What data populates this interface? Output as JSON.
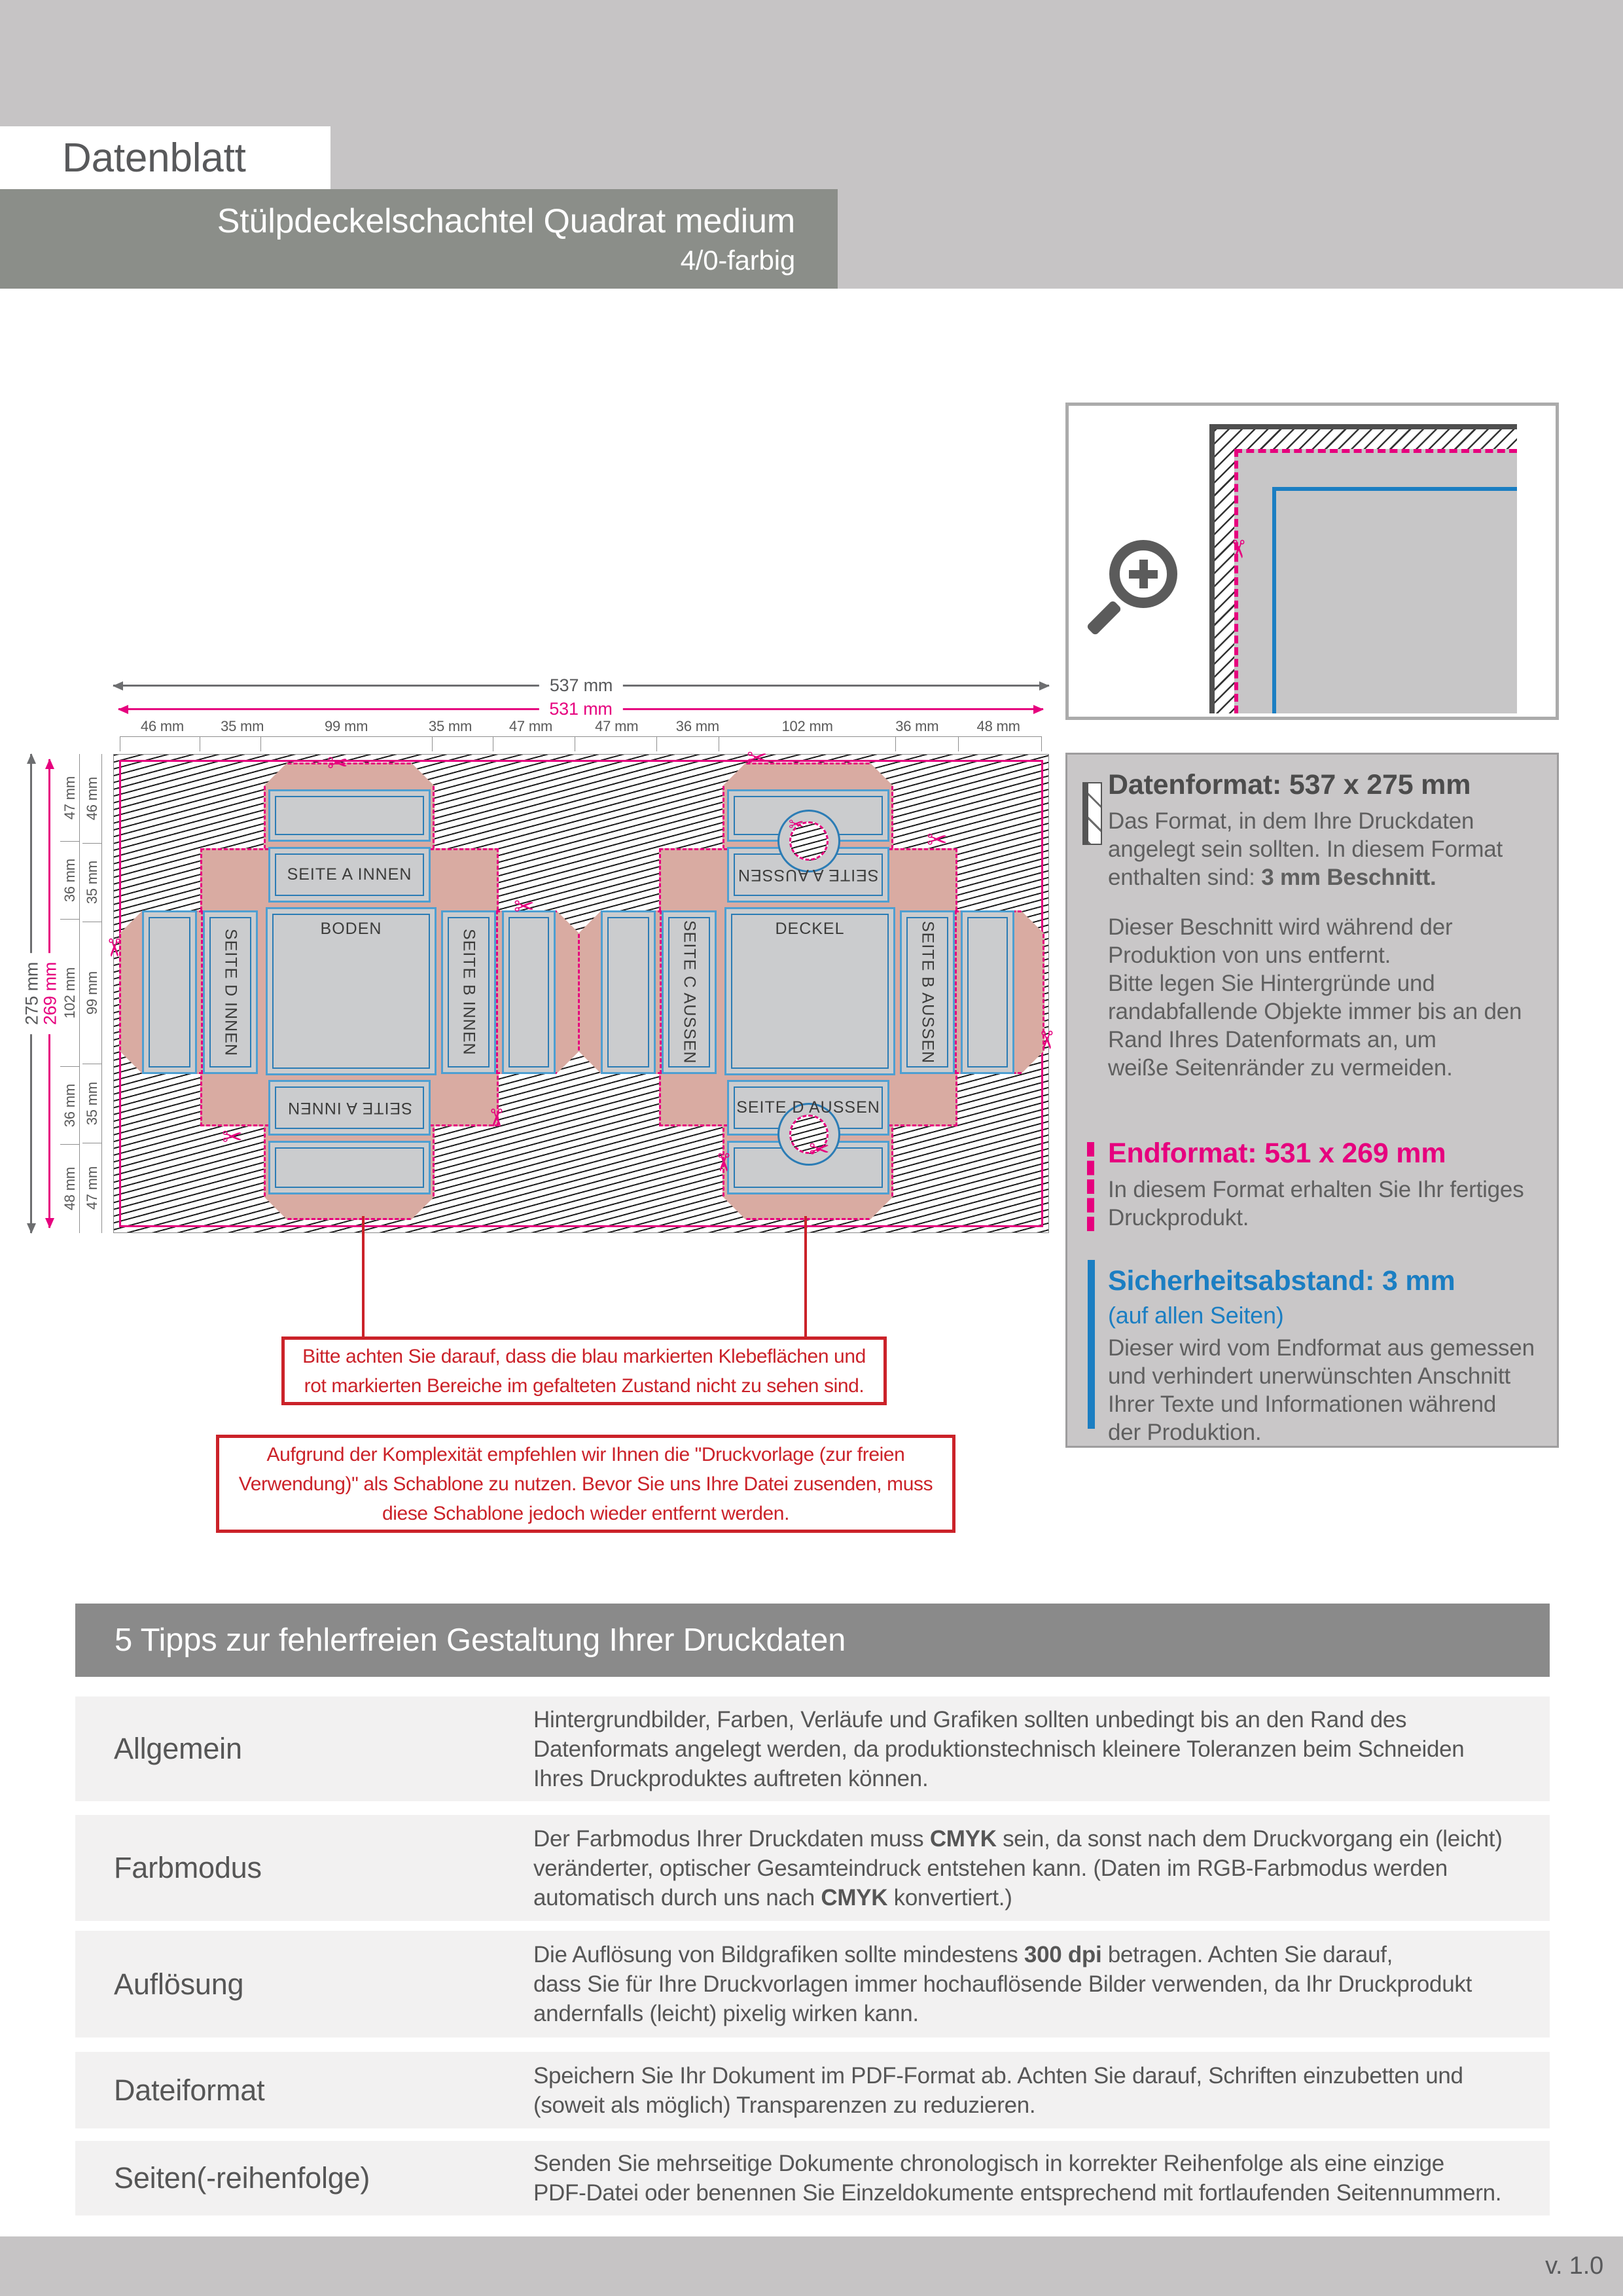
{
  "header": {
    "sheet_label": "Datenblatt",
    "product_title": "Stülpdeckelschachtel Quadrat medium",
    "color_variant": "4/0-farbig"
  },
  "icons": {
    "scissors": "✂"
  },
  "diagram": {
    "total_width_label": "537 mm",
    "end_width_label": "531 mm",
    "total_height_label": "275 mm",
    "end_height_label": "269 mm",
    "column_widths": [
      "46 mm",
      "35 mm",
      "99 mm",
      "35 mm",
      "47 mm",
      "47 mm",
      "36 mm",
      "102 mm",
      "36 mm",
      "48 mm"
    ],
    "row_heights_outer": [
      "47 mm",
      "36 mm",
      "102 mm",
      "36 mm",
      "48 mm"
    ],
    "row_heights_inner": [
      "46 mm",
      "35 mm",
      "99 mm",
      "35 mm",
      "47 mm"
    ],
    "left_box": {
      "top": "SEITE A INNEN",
      "left": "SEITE D INNEN",
      "center": "BODEN",
      "right": "SEITE B INNEN",
      "bottom": "SEITE A INNEN"
    },
    "right_box": {
      "top": "SEITE A AUSSEN",
      "left": "SEITE C AUSSEN",
      "center": "DECKEL",
      "right": "SEITE B AUSSEN",
      "bottom": "SEITE D AUSSEN"
    }
  },
  "notes": {
    "glue_note": "Bitte achten Sie darauf, dass die blau markierten Klebeflächen und\nrot markierten Bereiche im gefalteten Zustand nicht zu sehen sind.",
    "template_note": "Aufgrund der Komplexität empfehlen wir Ihnen die \"Druckvorlage (zur freien\nVerwendung)\" als Schablone zu nutzen. Bevor Sie uns Ihre Datei zusenden, muss\ndiese Schablone jedoch wieder entfernt werden."
  },
  "info_panel": {
    "datenformat": {
      "title": "Datenformat: 537 x 275 mm",
      "body_pre": "Das Format, in dem Ihre Druckdaten\nangelegt sein sollten. In diesem Format\nenthalten sind: ",
      "body_bold": "3 mm Beschnitt.",
      "paragraph": "Dieser Beschnitt wird während der\nProduktion von uns entfernt.\nBitte legen Sie Hintergründe und\nrandabfallende Objekte immer bis an den\nRand Ihres Datenformats an, um\nweiße Seitenränder zu vermeiden."
    },
    "endformat": {
      "title": "Endformat: 531 x 269 mm",
      "body": "In diesem Format erhalten Sie Ihr fertiges\nDruckprodukt."
    },
    "sicherheitsabstand": {
      "title": "Sicherheitsabstand: 3 mm",
      "subtitle": "(auf allen Seiten)",
      "body": "Dieser wird vom Endformat aus gemessen\nund verhindert unerwünschten Anschnitt\nIhrer Texte und Informationen während\nder Produktion."
    }
  },
  "tips": {
    "title": "5 Tipps zur fehlerfreien Gestaltung Ihrer Druckdaten",
    "rows": [
      {
        "label": "Allgemein",
        "pre": "Hintergrundbilder, Farben, Verläufe und Grafiken sollten unbedingt bis an den Rand des\nDatenformats angelegt werden, da produktionstechnisch kleinere Toleranzen beim Schneiden\nIhres Druckproduktes auftreten können.",
        "b1": "",
        "mid": "",
        "b2": "",
        "post": ""
      },
      {
        "label": "Farbmodus",
        "pre": "Der Farbmodus Ihrer Druckdaten muss ",
        "b1": "CMYK",
        "mid": " sein, da sonst nach dem Druckvorgang ein (leicht)\nveränderter, optischer Gesamteindruck entstehen kann. (Daten im RGB-Farbmodus werden\nautomatisch durch uns nach ",
        "b2": "CMYK",
        "post": " konvertiert.)"
      },
      {
        "label": "Auflösung",
        "pre": "Die Auflösung von Bildgrafiken sollte mindestens ",
        "b1": "300 dpi",
        "mid": " betragen. Achten Sie darauf,\ndass Sie für Ihre Druckvorlagen immer hochauflösende Bilder verwenden, da Ihr Druckprodukt\nandernfalls (leicht) pixelig wirken kann.",
        "b2": "",
        "post": ""
      },
      {
        "label": "Dateiformat",
        "pre": "Speichern Sie Ihr Dokument im PDF-Format ab. Achten Sie darauf, Schriften einzubetten und\n(soweit als möglich) Transparenzen zu reduzieren.",
        "b1": "",
        "mid": "",
        "b2": "",
        "post": ""
      },
      {
        "label": "Seiten(-reihenfolge)",
        "pre": "Senden Sie mehrseitige Dokumente chronologisch in korrekter Reihenfolge als eine einzige\nPDF-Datei oder benennen Sie Einzeldokumente entsprechend mit fortlaufenden Seitennummern.",
        "b1": "",
        "mid": "",
        "b2": "",
        "post": ""
      }
    ]
  },
  "footer": {
    "version": "v. 1.0"
  }
}
